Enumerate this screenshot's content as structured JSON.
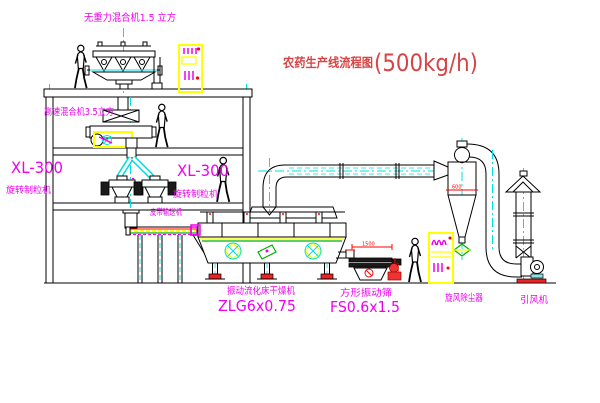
{
  "title": {
    "name": "农药生产线流程图",
    "capacity": "(500kg/h)"
  },
  "labels": {
    "top_mixer": "无重力混合机1.5 立方",
    "mid_mixer": "高速混合机3.5立方",
    "granulator_left": {
      "model": "XL-300",
      "name": "旋转制粒机"
    },
    "granulator_right": {
      "model": "XL-300",
      "name": "旋转制粒机"
    },
    "belt_conveyor": "皮带输送机",
    "dryer": {
      "name": "振动流化床干燥机",
      "model": "ZLG6x0.75"
    },
    "sieve": {
      "name": "方形振动筛",
      "model": "FS0.6x1.5"
    },
    "cyclone": "旋风除尘器",
    "fan": "引风机"
  },
  "dimensions": {
    "sieve_width": "1500",
    "sieve_height": "545",
    "cyclone_dia": "600"
  },
  "colors": {
    "label_magenta": "#f000f0",
    "title_red": "#d64545",
    "centerline_cyan": "#00e0e0",
    "highlight_yellow": "#ffff00",
    "accent_red": "#ff0000",
    "accent_green": "#00b200",
    "line_black": "#000000"
  }
}
